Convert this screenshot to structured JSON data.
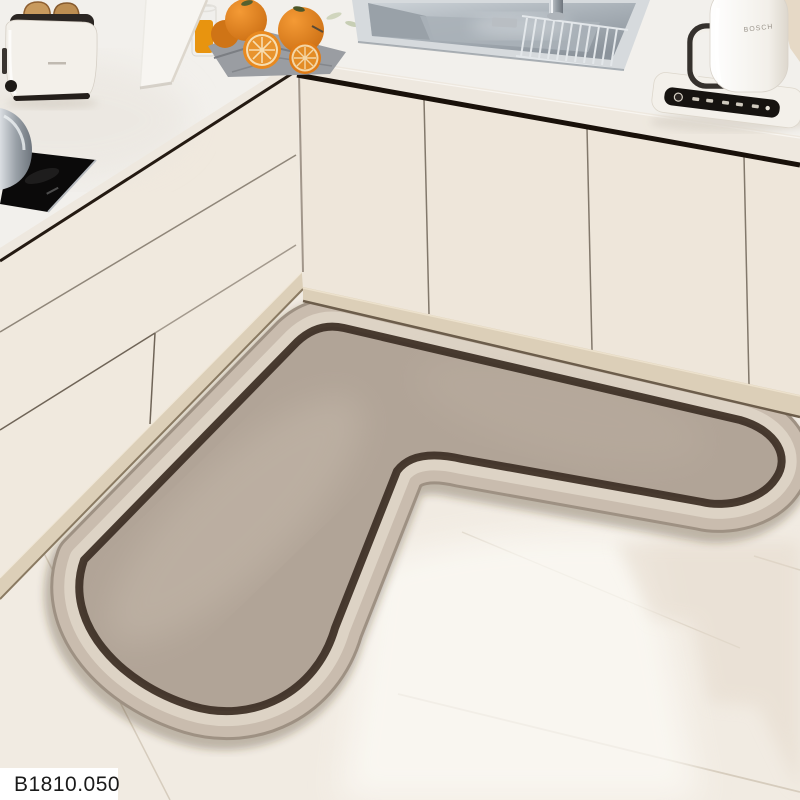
{
  "scene": {
    "description": "kitchen corner product photo with L-shaped mat",
    "product_label": "B1810.050",
    "kettle_brand": "BOSCH"
  },
  "palette": {
    "floor": "#f1ebe2",
    "floor_bright": "#fcfaf5",
    "floor_shadow": "#e6dccf",
    "floorseam": "#d6ccbd",
    "counter": "#f2f0ec",
    "edgeband": "#eee8df",
    "cabinet": "#f0e9de",
    "cabinet2": "#eee6da",
    "seam": "#6f6457",
    "toekick": "#dccfb8",
    "matfield": "#b1a497",
    "matband": "#c9bcae",
    "matrim": "#9e9183",
    "matline": "#ddd3c5",
    "matborder": "#3f3227",
    "stainless": "#b9c0c6",
    "orange": "#e07f1d",
    "cloth": "#9a9da2",
    "hob": "#0b0a0a",
    "labelbg": "#ffffff",
    "labeltext": "#1a1a1a"
  }
}
